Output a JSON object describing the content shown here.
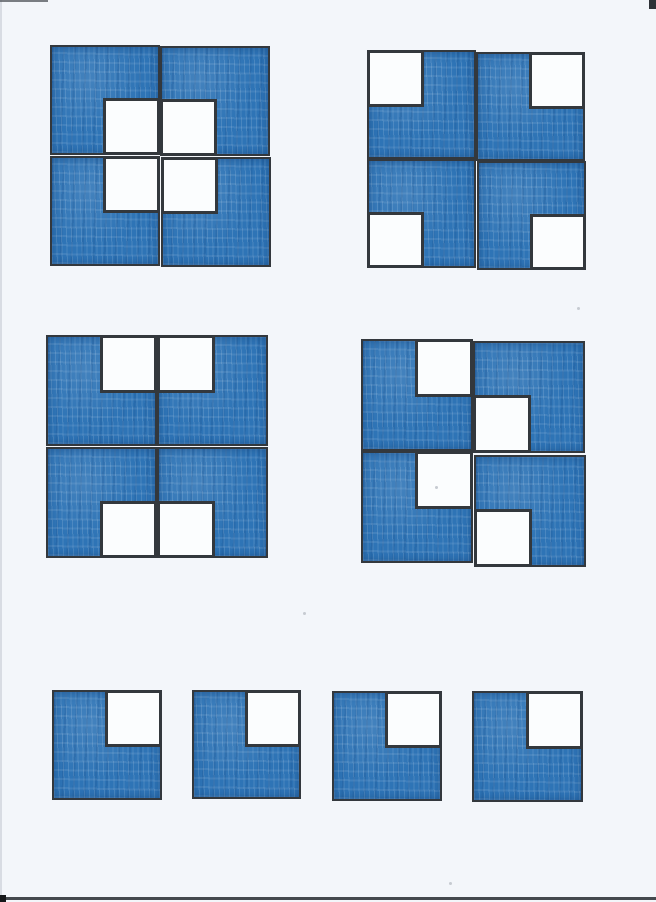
{
  "document": {
    "kind": "scanned-worksheet",
    "description": "Hand-coloured geometry worksheet: four 2x2 arrangements of blue square tiles, each tile having one white quarter-square corner, plus a bottom row of four identical single tiles with the white corner at top-right.",
    "width": 656,
    "height": 902
  },
  "colors": {
    "paper": "#f3f6fa",
    "tile_blue": "#2e74b6",
    "tile_blue_deep": "#1d5d9e",
    "tile_blue_light": "#6f9fd2",
    "outline": "#33383d",
    "white_fill": "#fbfdfe",
    "scan_edge": "#44494e"
  },
  "figures": [
    {
      "name": "figure-1-center-window",
      "pattern": "white corners all face the centre, forming one large white square window",
      "left": 50,
      "top": 45,
      "tile_size": 110,
      "tiles": [
        {
          "row": 0,
          "col": 0,
          "white_corner": "bottom-right"
        },
        {
          "row": 0,
          "col": 1,
          "white_corner": "bottom-left",
          "dy": 1
        },
        {
          "row": 1,
          "col": 0,
          "white_corner": "top-right",
          "dy": 1
        },
        {
          "row": 1,
          "col": 1,
          "white_corner": "top-left",
          "dy": 2,
          "dx": 1
        }
      ]
    },
    {
      "name": "figure-2-corner-windows-cross",
      "pattern": "white corners face outward at the four outer corners, blue forms a plus/cross",
      "left": 367,
      "top": 50,
      "tile_size": 109,
      "tiles": [
        {
          "row": 0,
          "col": 0,
          "white_corner": "top-left"
        },
        {
          "row": 0,
          "col": 1,
          "white_corner": "top-right",
          "dy": 2
        },
        {
          "row": 1,
          "col": 0,
          "white_corner": "bottom-left"
        },
        {
          "row": 1,
          "col": 1,
          "white_corner": "bottom-right",
          "dy": 2,
          "dx": 1
        }
      ]
    },
    {
      "name": "figure-3-top-bottom-windows",
      "pattern": "white squares paired at top-centre and bottom-centre, blue forms an H",
      "left": 46,
      "top": 335,
      "tile_size": 111,
      "tiles": [
        {
          "row": 0,
          "col": 0,
          "white_corner": "top-right"
        },
        {
          "row": 0,
          "col": 1,
          "white_corner": "top-left"
        },
        {
          "row": 1,
          "col": 0,
          "white_corner": "bottom-right",
          "dy": 1
        },
        {
          "row": 1,
          "col": 1,
          "white_corner": "bottom-left",
          "dy": 1
        }
      ]
    },
    {
      "name": "figure-4-zigzag-windows",
      "pattern": "white squares staggered diagonally down the middle in a zigzag",
      "left": 361,
      "top": 339,
      "tile_size": 112,
      "tiles": [
        {
          "row": 0,
          "col": 0,
          "white_corner": "top-right"
        },
        {
          "row": 0,
          "col": 1,
          "white_corner": "bottom-left",
          "dy": 2
        },
        {
          "row": 1,
          "col": 0,
          "white_corner": "top-right"
        },
        {
          "row": 1,
          "col": 1,
          "white_corner": "bottom-left",
          "dy": 4,
          "dx": 1
        }
      ]
    }
  ],
  "loose_tiles": [
    {
      "left": 52,
      "top": 690,
      "size": 110,
      "white_corner": "top-right"
    },
    {
      "left": 192,
      "top": 690,
      "size": 109,
      "white_corner": "top-right"
    },
    {
      "left": 332,
      "top": 691,
      "size": 110,
      "white_corner": "top-right"
    },
    {
      "left": 472,
      "top": 691,
      "size": 111,
      "white_corner": "top-right"
    }
  ],
  "scan_artifacts": {
    "specks": [
      {
        "x": 577,
        "y": 307
      },
      {
        "x": 435,
        "y": 486
      },
      {
        "x": 303,
        "y": 612
      },
      {
        "x": 449,
        "y": 882
      }
    ],
    "bottom_edge_y": 897,
    "bottom_blob_y": 895,
    "top_right_mark": {
      "x": 649,
      "y": 0,
      "w": 7,
      "h": 9
    }
  }
}
